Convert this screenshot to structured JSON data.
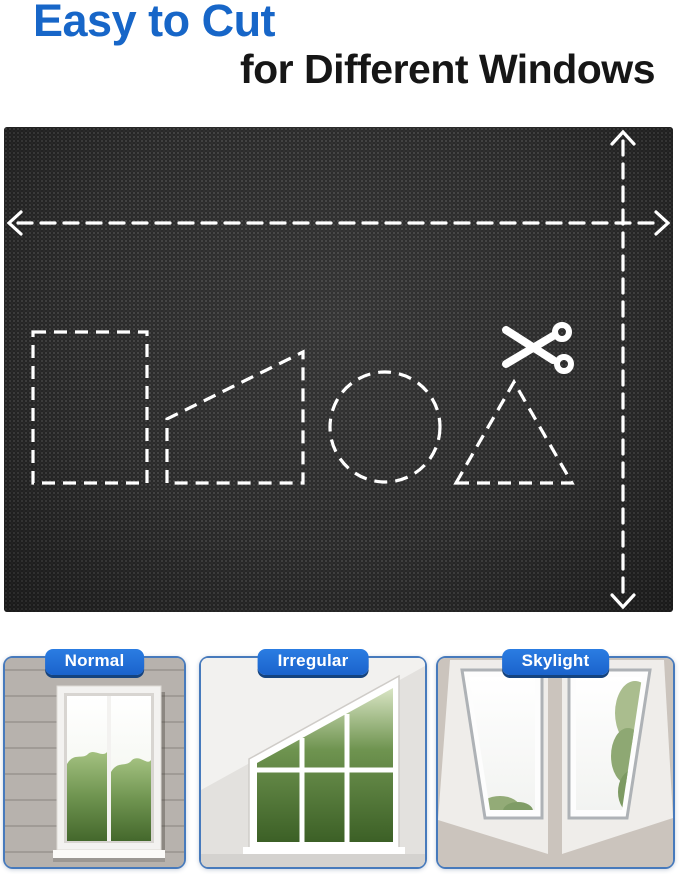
{
  "header": {
    "line1": "Easy to Cut",
    "line2": "for Different Windows"
  },
  "fabric_panel": {
    "material": "blackout fabric swatch with dashed cutting guides",
    "cut_shapes": [
      "rectangle",
      "trapezoid",
      "circle",
      "triangle"
    ],
    "icons": [
      "scissors-icon",
      "left-arrow-icon",
      "right-arrow-icon",
      "up-arrow-icon",
      "down-arrow-icon"
    ]
  },
  "window_types": [
    {
      "label": "Normal"
    },
    {
      "label": "Irregular"
    },
    {
      "label": "Skylight"
    }
  ],
  "colors": {
    "accent_blue": "#1766c8",
    "badge_blue": "#1e6ed2",
    "card_border_blue": "#477abc",
    "fabric_black": "#232323",
    "guide_line_white": "#ffffff",
    "headline_dark": "#161616"
  }
}
